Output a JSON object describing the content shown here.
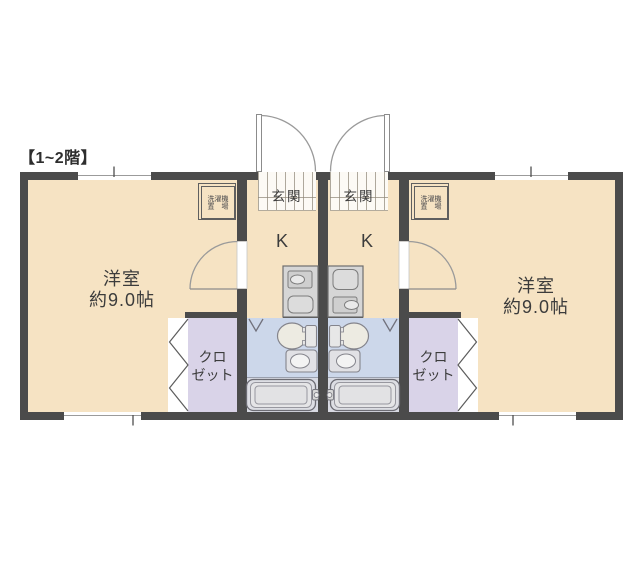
{
  "title": "【1~2階】",
  "plan": {
    "units": [
      {
        "id": "left",
        "room": {
          "label": "洋室",
          "size": "約9.0帖"
        },
        "kitchen": {
          "label": "K"
        },
        "entrance": {
          "label": "玄関"
        },
        "closet": {
          "line1": "クロ",
          "line2": "ゼット"
        },
        "laundry": {
          "line1": "洗濯機",
          "line2": "置　場"
        }
      },
      {
        "id": "right",
        "room": {
          "label": "洋室",
          "size": "約9.0帖"
        },
        "kitchen": {
          "label": "K"
        },
        "entrance": {
          "label": "玄関"
        },
        "closet": {
          "line1": "クロ",
          "line2": "ゼット"
        },
        "laundry": {
          "line1": "洗濯機",
          "line2": "置　場"
        }
      }
    ],
    "colors": {
      "wall": "#4b4b4b",
      "floor": "#f6e3c3",
      "closet_floor": "#d9d3e8",
      "bathroom_floor": "#ccd7ea",
      "bath_zone_floor": "#d8dae3",
      "fixture_gray": "#d6d6d6"
    }
  }
}
